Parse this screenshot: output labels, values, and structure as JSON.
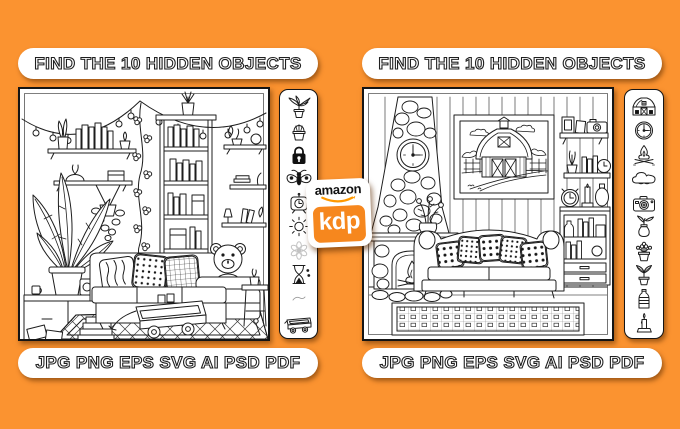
{
  "colors": {
    "background": "#FB9330",
    "card": "#FFFFFF",
    "line_art": "#1D1D1D",
    "kdp_orange": "#F6871E",
    "smile_orange": "#FF9900"
  },
  "left_panel": {
    "header_label": "FIND THE 10 HIDDEN OBJECTS",
    "formats_label": "JPG PNG EPS SVG AI PSD PDF",
    "scene_name": "boho-living-room-coloring-page",
    "hidden_object_icons": [
      "houseplant-icon",
      "cactus-icon",
      "padlock-icon",
      "moth-icon",
      "tv-clock-icon",
      "sun-icon",
      "flower-icon",
      "hourglass-icon",
      "doodle-mark-icon",
      "wagon-icon"
    ]
  },
  "right_panel": {
    "header_label": "FIND THE 10 HIDDEN OBJECTS",
    "formats_label": "JPG PNG EPS SVG AI PSD PDF",
    "scene_name": "farmhouse-living-room-coloring-page",
    "hidden_object_icons": [
      "barn-icon",
      "wall-clock-icon",
      "campfire-icon",
      "cloud-icon",
      "camera-icon",
      "vase-sprout-icon",
      "flower-pot-icon",
      "plant-sprout-icon",
      "bottle-icon",
      "candle-icon"
    ]
  },
  "kdp_badge": {
    "brand": "amazon",
    "logo": "kdp"
  }
}
